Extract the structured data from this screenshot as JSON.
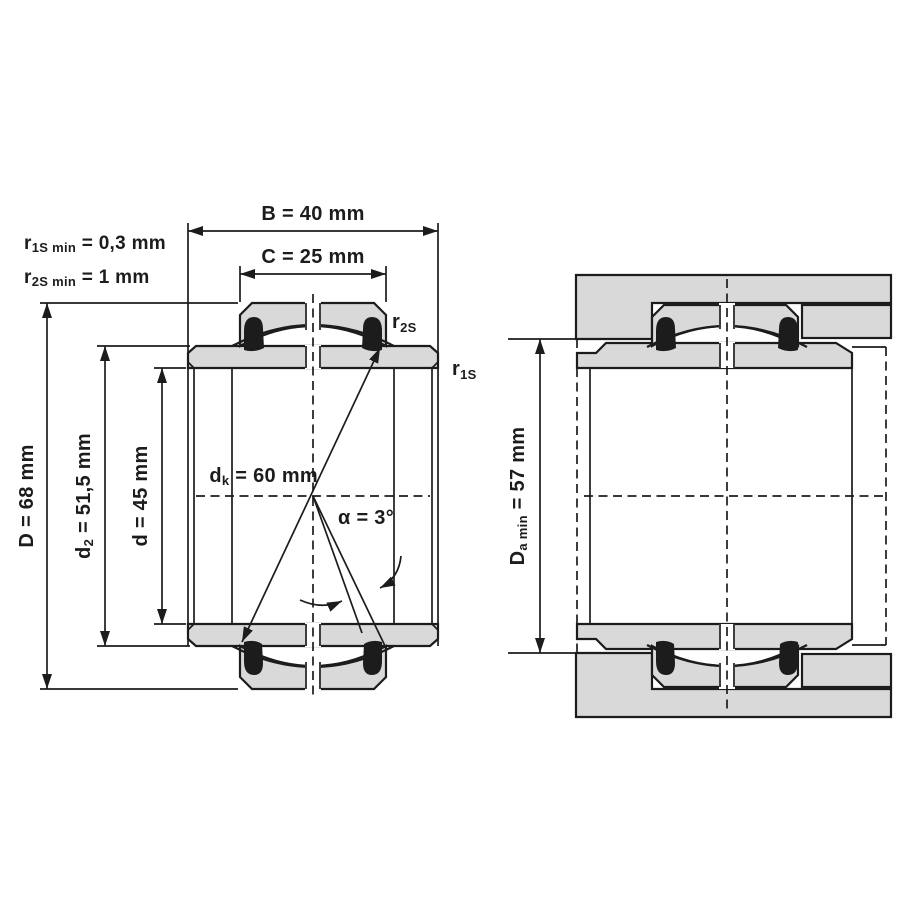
{
  "diagram": {
    "type": "bearing-dimension-drawing",
    "labels": {
      "b": "B = 40 mm",
      "c": "C = 25 mm",
      "r1s_min": {
        "base": "r",
        "sub": "1S min",
        "rest": " = 0,3 mm"
      },
      "r2s_min": {
        "base": "r",
        "sub": "2S min",
        "rest": " = 1 mm"
      },
      "D": "D = 68 mm",
      "d2": {
        "base": "d",
        "sub": "2",
        "rest": " = 51,5 mm"
      },
      "d": {
        "base": "d",
        "sub": "",
        "rest": " = 45 mm"
      },
      "dk": {
        "base": "d",
        "sub": "k",
        "rest": " = 60 mm"
      },
      "alpha": "α = 3°",
      "r2s_callout": {
        "base": "r",
        "sub": "2S"
      },
      "r1s_callout": {
        "base": "r",
        "sub": "1S"
      },
      "da": {
        "base": "D",
        "sub": "a min",
        "rest": " = 57 mm"
      }
    },
    "dimensions": {
      "B": "40 mm",
      "C": "25 mm",
      "D": "68 mm",
      "d": "45 mm",
      "d2": "51,5 mm",
      "dk": "60 mm",
      "alpha": "3°",
      "r1S_min": "0,3 mm",
      "r2S_min": "1 mm",
      "Da_min": "57 mm"
    },
    "colors": {
      "part_fill": "#d9d9d9",
      "line": "#1c1c1c",
      "seal": "#1c1c1c",
      "background": "#ffffff"
    }
  }
}
